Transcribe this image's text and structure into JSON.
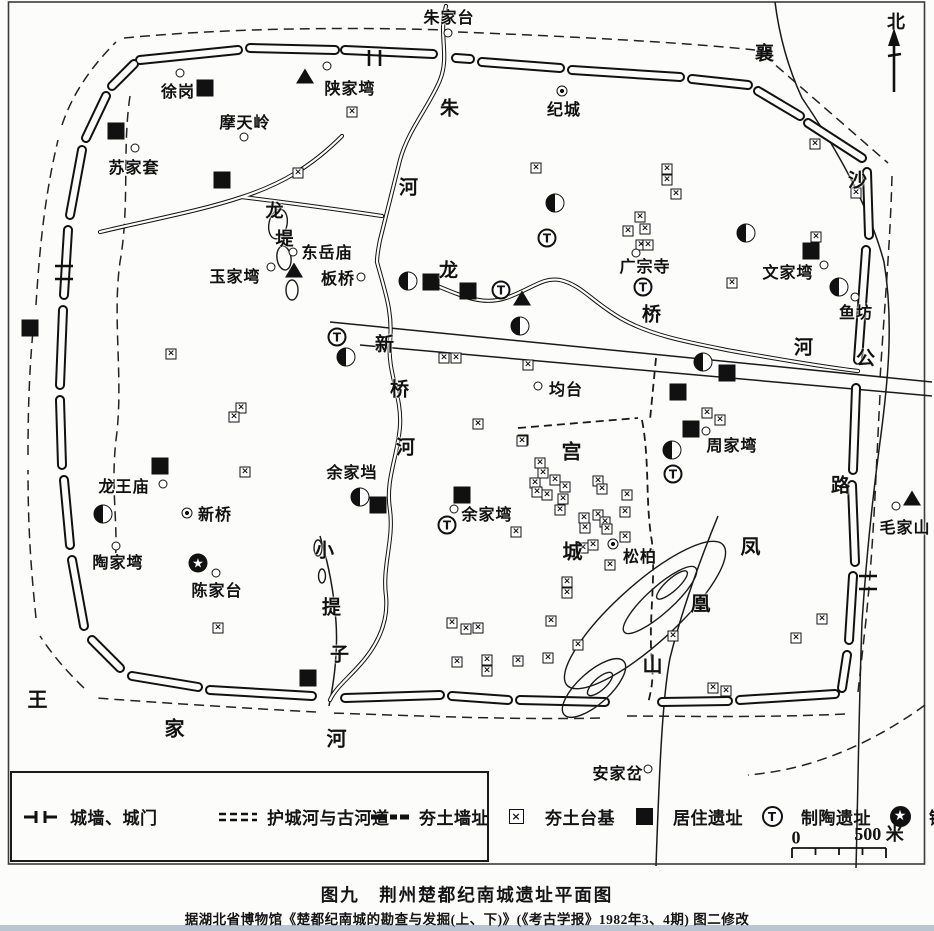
{
  "title_block": {
    "caption": "图九　荆州楚都纪南城遗址平面图",
    "source": "据湖北省博物馆《楚都纪南城的勘查与发掘(上、下)》(《考古学报》1982年3、4期) 图二修改"
  },
  "compass": {
    "label": "北"
  },
  "scale_bar": {
    "start": "0",
    "end": "500 米"
  },
  "legend": {
    "columns": [
      [
        {
          "sym": "wall-gate",
          "label": "城墙、城门"
        },
        {
          "sym": "moat",
          "label": "护城河与古河道"
        },
        {
          "sym": "rammed-wall",
          "label": "夯土墙址"
        }
      ],
      [
        {
          "sym": "tai",
          "label": "夯土台基"
        },
        {
          "sym": "ju",
          "label": "居住遗址"
        },
        {
          "sym": "tao",
          "label": "制陶遗址"
        }
      ],
      [
        {
          "sym": "zhu",
          "label": "铸铜遗址"
        },
        {
          "sym": "mu",
          "label": "墓　葬"
        },
        {
          "sym": "jing",
          "label": "井　群"
        }
      ]
    ]
  },
  "map": {
    "marker_glyphs": {
      "tao": "T",
      "zhu": "★",
      "tai": "×"
    },
    "marker_names": {
      "ju": "residence-site-marker",
      "tai": "rammed-earth-platform-marker",
      "tao": "pottery-site-marker",
      "zhu": "bronze-casting-site-marker",
      "mu": "tomb-marker",
      "jing": "well-cluster-marker",
      "o": "place-dot-marker",
      "odot": "place-circled-dot-marker"
    },
    "labels": [
      {
        "text": "朱家台",
        "x": 449,
        "y": 16
      },
      {
        "text": "徐岗",
        "x": 178,
        "y": 90
      },
      {
        "text": "陕家塆",
        "x": 350,
        "y": 87
      },
      {
        "text": "摩天岭",
        "x": 245,
        "y": 121
      },
      {
        "text": "苏家套",
        "x": 134,
        "y": 166
      },
      {
        "text": "纪城",
        "x": 564,
        "y": 108
      },
      {
        "text": "东岳庙",
        "x": 327,
        "y": 251
      },
      {
        "text": "玉家塆",
        "x": 235,
        "y": 275
      },
      {
        "text": "板桥",
        "x": 338,
        "y": 277
      },
      {
        "text": "广宗寺",
        "x": 645,
        "y": 265
      },
      {
        "text": "文家塆",
        "x": 788,
        "y": 271
      },
      {
        "text": "鱼坊",
        "x": 856,
        "y": 311
      },
      {
        "text": "均台",
        "x": 566,
        "y": 388
      },
      {
        "text": "龙王庙",
        "x": 124,
        "y": 485
      },
      {
        "text": "新桥",
        "x": 215,
        "y": 513
      },
      {
        "text": "陶家塆",
        "x": 118,
        "y": 561
      },
      {
        "text": "陈家台",
        "x": 217,
        "y": 589
      },
      {
        "text": "余家垱",
        "x": 352,
        "y": 471
      },
      {
        "text": "余家塆",
        "x": 487,
        "y": 513
      },
      {
        "text": "周家塆",
        "x": 732,
        "y": 444
      },
      {
        "text": "毛家山",
        "x": 905,
        "y": 526
      },
      {
        "text": "松柏",
        "x": 640,
        "y": 555
      },
      {
        "text": "安家岔",
        "x": 618,
        "y": 772
      },
      {
        "text": "龙",
        "x": 275,
        "y": 210,
        "s": 18
      },
      {
        "text": "堤",
        "x": 285,
        "y": 238,
        "s": 18
      },
      {
        "text": "朱",
        "x": 450,
        "y": 107,
        "s": 19
      },
      {
        "text": "河",
        "x": 409,
        "y": 186,
        "s": 19
      },
      {
        "text": "新",
        "x": 385,
        "y": 343,
        "s": 19
      },
      {
        "text": "桥",
        "x": 400,
        "y": 388,
        "s": 19
      },
      {
        "text": "河",
        "x": 406,
        "y": 446,
        "s": 19
      },
      {
        "text": "龙",
        "x": 449,
        "y": 269,
        "s": 19
      },
      {
        "text": "桥",
        "x": 652,
        "y": 313,
        "s": 19
      },
      {
        "text": "河",
        "x": 804,
        "y": 346,
        "s": 19
      },
      {
        "text": "襄",
        "x": 765,
        "y": 52,
        "s": 19
      },
      {
        "text": "沙",
        "x": 858,
        "y": 179,
        "s": 19
      },
      {
        "text": "公",
        "x": 866,
        "y": 357,
        "s": 19
      },
      {
        "text": "路",
        "x": 841,
        "y": 484,
        "s": 19
      },
      {
        "text": "宫",
        "x": 572,
        "y": 450,
        "s": 20
      },
      {
        "text": "城",
        "x": 573,
        "y": 550,
        "s": 20
      },
      {
        "text": "凤",
        "x": 751,
        "y": 545,
        "s": 20
      },
      {
        "text": "凰",
        "x": 701,
        "y": 602,
        "s": 20
      },
      {
        "text": "山",
        "x": 653,
        "y": 663,
        "s": 20
      },
      {
        "text": "小",
        "x": 325,
        "y": 549,
        "s": 19
      },
      {
        "text": "提",
        "x": 332,
        "y": 606,
        "s": 19
      },
      {
        "text": "子",
        "x": 340,
        "y": 653,
        "s": 19
      },
      {
        "text": "王",
        "x": 38,
        "y": 698,
        "s": 20
      },
      {
        "text": "家",
        "x": 175,
        "y": 727,
        "s": 20
      },
      {
        "text": "河",
        "x": 337,
        "y": 737,
        "s": 20
      }
    ],
    "markers": [
      {
        "t": "tai",
        "x": 352,
        "y": 112
      },
      {
        "t": "tai",
        "x": 298,
        "y": 173
      },
      {
        "t": "tai",
        "x": 815,
        "y": 144
      },
      {
        "t": "tai",
        "x": 856,
        "y": 193
      },
      {
        "t": "tai",
        "x": 816,
        "y": 237
      },
      {
        "t": "tai",
        "x": 732,
        "y": 283
      },
      {
        "t": "tai",
        "x": 536,
        "y": 168
      },
      {
        "t": "tai",
        "x": 667,
        "y": 169
      },
      {
        "t": "tai",
        "x": 667,
        "y": 180
      },
      {
        "t": "tai",
        "x": 676,
        "y": 194
      },
      {
        "t": "tai",
        "x": 640,
        "y": 217
      },
      {
        "t": "tai",
        "x": 628,
        "y": 231
      },
      {
        "t": "tai",
        "x": 645,
        "y": 229
      },
      {
        "t": "tai",
        "x": 641,
        "y": 245
      },
      {
        "t": "tai",
        "x": 648,
        "y": 245
      },
      {
        "t": "tai",
        "x": 444,
        "y": 358
      },
      {
        "t": "tai",
        "x": 456,
        "y": 358
      },
      {
        "t": "tai",
        "x": 241,
        "y": 408
      },
      {
        "t": "tai",
        "x": 234,
        "y": 417
      },
      {
        "t": "tai",
        "x": 171,
        "y": 354
      },
      {
        "t": "tai",
        "x": 245,
        "y": 472
      },
      {
        "t": "tai",
        "x": 528,
        "y": 365
      },
      {
        "t": "tai",
        "x": 523,
        "y": 440
      },
      {
        "t": "tai",
        "x": 478,
        "y": 424
      },
      {
        "t": "tai",
        "x": 522,
        "y": 441
      },
      {
        "t": "tai",
        "x": 540,
        "y": 463
      },
      {
        "t": "tai",
        "x": 543,
        "y": 473
      },
      {
        "t": "tai",
        "x": 535,
        "y": 483
      },
      {
        "t": "tai",
        "x": 555,
        "y": 480
      },
      {
        "t": "tai",
        "x": 537,
        "y": 492
      },
      {
        "t": "tai",
        "x": 565,
        "y": 487
      },
      {
        "t": "tai",
        "x": 547,
        "y": 495
      },
      {
        "t": "tai",
        "x": 563,
        "y": 499
      },
      {
        "t": "tai",
        "x": 598,
        "y": 481
      },
      {
        "t": "tai",
        "x": 602,
        "y": 489
      },
      {
        "t": "tai",
        "x": 560,
        "y": 510
      },
      {
        "t": "tai",
        "x": 516,
        "y": 532
      },
      {
        "t": "tai",
        "x": 584,
        "y": 518
      },
      {
        "t": "tai",
        "x": 585,
        "y": 528
      },
      {
        "t": "tai",
        "x": 598,
        "y": 515
      },
      {
        "t": "tai",
        "x": 605,
        "y": 522
      },
      {
        "t": "tai",
        "x": 607,
        "y": 529
      },
      {
        "t": "tai",
        "x": 627,
        "y": 495
      },
      {
        "t": "tai",
        "x": 625,
        "y": 512
      },
      {
        "t": "tai",
        "x": 593,
        "y": 545
      },
      {
        "t": "tai",
        "x": 625,
        "y": 537
      },
      {
        "t": "tai",
        "x": 583,
        "y": 548
      },
      {
        "t": "tai",
        "x": 610,
        "y": 565
      },
      {
        "t": "tai",
        "x": 567,
        "y": 582
      },
      {
        "t": "tai",
        "x": 567,
        "y": 593
      },
      {
        "t": "tai",
        "x": 578,
        "y": 645
      },
      {
        "t": "tai",
        "x": 452,
        "y": 623
      },
      {
        "t": "tai",
        "x": 466,
        "y": 629
      },
      {
        "t": "tai",
        "x": 478,
        "y": 628
      },
      {
        "t": "tai",
        "x": 551,
        "y": 621
      },
      {
        "t": "tai",
        "x": 548,
        "y": 658
      },
      {
        "t": "tai",
        "x": 457,
        "y": 662
      },
      {
        "t": "tai",
        "x": 487,
        "y": 660
      },
      {
        "t": "tai",
        "x": 518,
        "y": 661
      },
      {
        "t": "tai",
        "x": 487,
        "y": 671
      },
      {
        "t": "tai",
        "x": 673,
        "y": 636
      },
      {
        "t": "tai",
        "x": 822,
        "y": 619
      },
      {
        "t": "tai",
        "x": 796,
        "y": 638
      },
      {
        "t": "tai",
        "x": 218,
        "y": 628
      },
      {
        "t": "tai",
        "x": 707,
        "y": 413
      },
      {
        "t": "tai",
        "x": 720,
        "y": 420
      },
      {
        "t": "tai",
        "x": 713,
        "y": 688
      },
      {
        "t": "tai",
        "x": 726,
        "y": 691
      },
      {
        "t": "ju",
        "x": 205,
        "y": 88
      },
      {
        "t": "ju",
        "x": 116,
        "y": 131
      },
      {
        "t": "ju",
        "x": 222,
        "y": 180
      },
      {
        "t": "ju",
        "x": 30,
        "y": 328
      },
      {
        "t": "ju",
        "x": 431,
        "y": 282
      },
      {
        "t": "ju",
        "x": 468,
        "y": 291
      },
      {
        "t": "ju",
        "x": 811,
        "y": 251
      },
      {
        "t": "ju",
        "x": 160,
        "y": 466
      },
      {
        "t": "ju",
        "x": 462,
        "y": 495
      },
      {
        "t": "ju",
        "x": 378,
        "y": 505
      },
      {
        "t": "ju",
        "x": 727,
        "y": 373
      },
      {
        "t": "ju",
        "x": 678,
        "y": 392
      },
      {
        "t": "ju",
        "x": 691,
        "y": 429
      },
      {
        "t": "ju",
        "x": 308,
        "y": 678
      },
      {
        "t": "mu",
        "x": 305,
        "y": 76
      },
      {
        "t": "mu",
        "x": 294,
        "y": 270
      },
      {
        "t": "mu",
        "x": 522,
        "y": 298
      },
      {
        "t": "mu",
        "x": 912,
        "y": 498
      },
      {
        "t": "tao",
        "x": 547,
        "y": 238
      },
      {
        "t": "tao",
        "x": 501,
        "y": 290
      },
      {
        "t": "tao",
        "x": 643,
        "y": 287
      },
      {
        "t": "tao",
        "x": 337,
        "y": 337
      },
      {
        "t": "tao",
        "x": 447,
        "y": 525
      },
      {
        "t": "tao",
        "x": 673,
        "y": 474
      },
      {
        "t": "jing",
        "x": 555,
        "y": 203
      },
      {
        "t": "jing",
        "x": 746,
        "y": 233
      },
      {
        "t": "jing",
        "x": 839,
        "y": 287
      },
      {
        "t": "jing",
        "x": 408,
        "y": 281
      },
      {
        "t": "jing",
        "x": 346,
        "y": 357
      },
      {
        "t": "jing",
        "x": 520,
        "y": 326
      },
      {
        "t": "jing",
        "x": 703,
        "y": 362
      },
      {
        "t": "jing",
        "x": 672,
        "y": 450
      },
      {
        "t": "jing",
        "x": 103,
        "y": 514
      },
      {
        "t": "jing",
        "x": 360,
        "y": 497
      },
      {
        "t": "zhu",
        "x": 198,
        "y": 563
      },
      {
        "t": "o",
        "x": 448,
        "y": 33
      },
      {
        "t": "o",
        "x": 180,
        "y": 73
      },
      {
        "t": "o",
        "x": 327,
        "y": 66
      },
      {
        "t": "o",
        "x": 135,
        "y": 148
      },
      {
        "t": "o",
        "x": 244,
        "y": 137
      },
      {
        "t": "o",
        "x": 293,
        "y": 252
      },
      {
        "t": "o",
        "x": 271,
        "y": 267
      },
      {
        "t": "o",
        "x": 361,
        "y": 277
      },
      {
        "t": "o",
        "x": 636,
        "y": 253
      },
      {
        "t": "o",
        "x": 824,
        "y": 265
      },
      {
        "t": "o",
        "x": 855,
        "y": 297
      },
      {
        "t": "o",
        "x": 538,
        "y": 386
      },
      {
        "t": "o",
        "x": 163,
        "y": 484
      },
      {
        "t": "o",
        "x": 116,
        "y": 546
      },
      {
        "t": "o",
        "x": 216,
        "y": 573
      },
      {
        "t": "o",
        "x": 454,
        "y": 509
      },
      {
        "t": "o",
        "x": 706,
        "y": 431
      },
      {
        "t": "o",
        "x": 896,
        "y": 506
      },
      {
        "t": "o",
        "x": 648,
        "y": 769
      },
      {
        "t": "odot",
        "x": 562,
        "y": 91
      },
      {
        "t": "odot",
        "x": 187,
        "y": 513
      },
      {
        "t": "odot",
        "x": 613,
        "y": 544
      }
    ]
  }
}
